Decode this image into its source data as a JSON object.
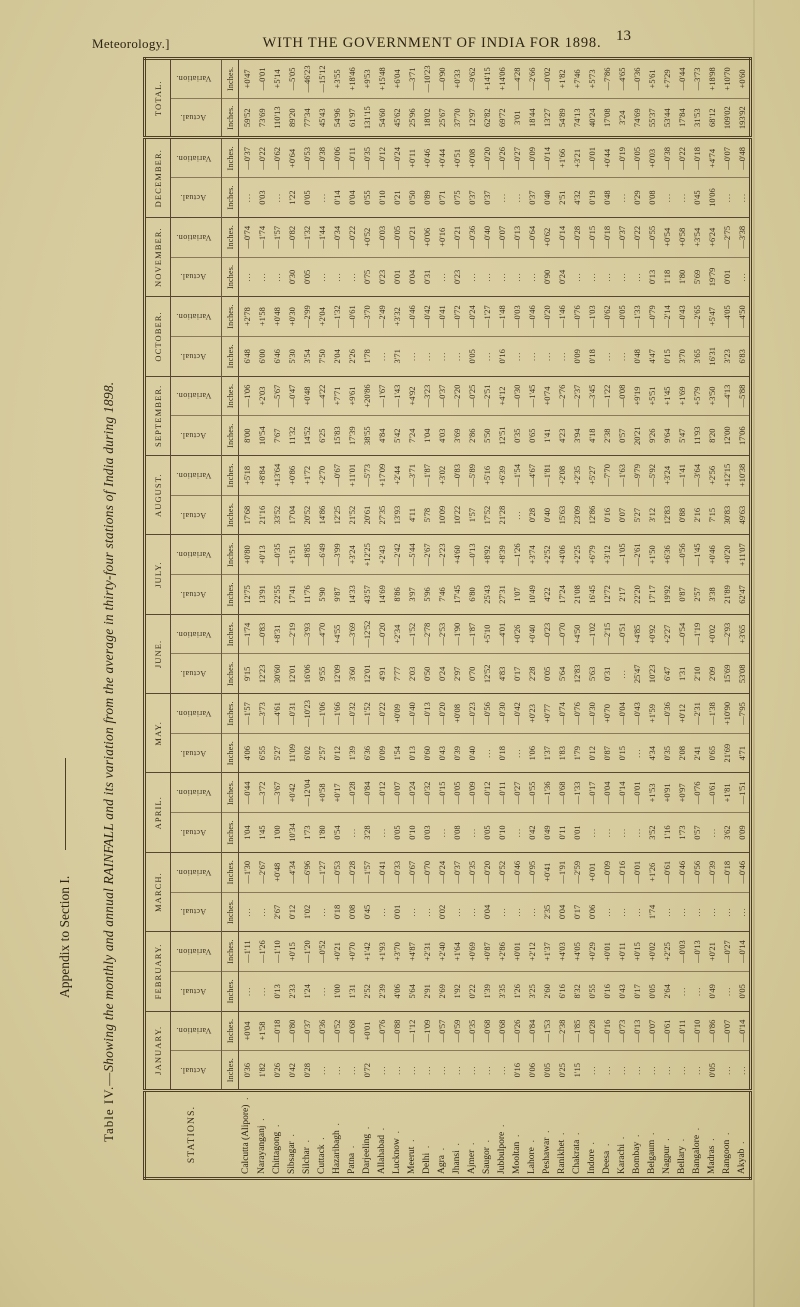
{
  "page": {
    "margin_note": "Meteorology.]",
    "header_title": "WITH THE GOVERNMENT OF INDIA FOR 1898.",
    "page_number": "13",
    "side_note": "Appendix to Section I.",
    "table_title_prefix": "Table IV.—",
    "table_title_rest": "Showing the monthly and annual RAINFALL and its variation from the average in thirty-four stations of India during 1898."
  },
  "table": {
    "stations_header": "Stations.",
    "unit_label": "Inches.",
    "sub_headers": [
      "Actual.",
      "Variation."
    ],
    "stations": [
      "Calcutta (Alipore)",
      "Narayanganj",
      "Chittagong",
      "Sibsagar",
      "Silchar",
      "Cuttack",
      "Hazaribagh",
      "Patna",
      "Darjeeling",
      "Allahabad",
      "Lucknow",
      "Meerut",
      "Delhi",
      "Agra",
      "Jhansi",
      "Ajmer",
      "Saugor",
      "Jubbulpore",
      "Mooltan",
      "Lahore",
      "Peshawar",
      "Ranikhet",
      "Chakrata",
      "Indore",
      "Deesa",
      "Karachi",
      "Bombay",
      "Belgaum",
      "Nagpur",
      "Bellary",
      "Bangalore",
      "Madras",
      "Rangoon",
      "Akyab"
    ],
    "months": [
      {
        "label": "January.",
        "actual": [
          "0'36",
          "1'82",
          "0'26",
          "0'42",
          "0'28",
          "...",
          "...",
          "...",
          "0'72",
          "...",
          "...",
          "...",
          "...",
          "...",
          "...",
          "...",
          "...",
          "...",
          "0'16",
          "0'06",
          "0'05",
          "0'25",
          "1'15",
          "...",
          "...",
          "...",
          "...",
          "...",
          "...",
          "...",
          "...",
          "0'05",
          "...",
          "..."
        ],
        "variation": [
          "+0'04",
          "+1'58",
          "—0'18",
          "—0'80",
          "—0'37",
          "—0'36",
          "—0'52",
          "—0'68",
          "+0'01",
          "—0'76",
          "—0'88",
          "—1'12",
          "—1'09",
          "—0'57",
          "—0'59",
          "—0'35",
          "—0'68",
          "—0'68",
          "—0'26",
          "—0'84",
          "—1'53",
          "—2'38",
          "—1'85",
          "—0'28",
          "—0'16",
          "—0'73",
          "—0'13",
          "—0'07",
          "—0'61",
          "—0'11",
          "—0'10",
          "—0'86",
          "—0'07",
          "—0'14"
        ]
      },
      {
        "label": "February.",
        "actual": [
          "...",
          "...",
          "0'13",
          "2'33",
          "1'24",
          "...",
          "1'00",
          "1'31",
          "2'52",
          "2'39",
          "4'06",
          "5'64",
          "2'91",
          "2'69",
          "1'92",
          "0'22",
          "1'39",
          "3'35",
          "1'26",
          "3'25",
          "2'60",
          "6'16",
          "8'32",
          "0'55",
          "0'16",
          "0'43",
          "0'17",
          "0'05",
          "2'64",
          "...",
          "...",
          "0'49",
          "...",
          "0'05"
        ],
        "variation": [
          "—1'11",
          "—1'26",
          "—1'10",
          "+0'15",
          "—1'20",
          "—0'52",
          "+0'21",
          "+0'70",
          "+1'42",
          "+1'93",
          "+3'70",
          "+4'87",
          "+2'31",
          "+2'40",
          "+1'64",
          "+0'69",
          "+0'87",
          "+2'86",
          "+0'01",
          "+2'12",
          "+1'37",
          "+4'03",
          "+4'05",
          "+0'29",
          "+0'01",
          "+0'11",
          "+0'15",
          "+0'02",
          "+2'25",
          "—0'03",
          "—0'13",
          "+0'21",
          "—0'27",
          "—0'14"
        ]
      },
      {
        "label": "March.",
        "actual": [
          "...",
          "...",
          "2'67",
          "0'12",
          "1'02",
          "...",
          "0'18",
          "0'08",
          "0'45",
          "...",
          "0'01",
          "...",
          "...",
          "0'02",
          "...",
          "...",
          "0'04",
          "...",
          "...",
          "...",
          "2'35",
          "0'04",
          "0'17",
          "0'06",
          "...",
          "...",
          "...",
          "1'74",
          "...",
          "...",
          "...",
          "...",
          "...",
          "..."
        ],
        "variation": [
          "—1'30",
          "—2'67",
          "+0'48",
          "—4'34",
          "—6'96",
          "—1'27",
          "—0'53",
          "—0'28",
          "—1'57",
          "—0'41",
          "—0'33",
          "—0'67",
          "—0'70",
          "—0'24",
          "—0'37",
          "—0'35",
          "—0'20",
          "—0'52",
          "—0'46",
          "—0'95",
          "+0'41",
          "—1'91",
          "—2'59",
          "+0'01",
          "—0'09",
          "—0'16",
          "—0'01",
          "+1'26",
          "—0'61",
          "—0'46",
          "—0'56",
          "—0'39",
          "—0'18",
          "—0'46"
        ]
      },
      {
        "label": "April.",
        "actual": [
          "1'04",
          "1'45",
          "1'00",
          "10'34",
          "1'73",
          "1'80",
          "0'54",
          "...",
          "3'28",
          "...",
          "0'05",
          "0'10",
          "0'03",
          "...",
          "0'08",
          "...",
          "0'05",
          "0'10",
          "...",
          "0'42",
          "0'49",
          "0'11",
          "0'01",
          "...",
          "...",
          "...",
          "...",
          "3'52",
          "1'16",
          "1'73",
          "0'57",
          "...",
          "3'62",
          "0'09"
        ],
        "variation": [
          "—0'44",
          "—3'72",
          "—3'67",
          "+0'42",
          "—12'04",
          "+0'58",
          "+0'17",
          "—0'28",
          "—0'84",
          "—0'12",
          "—0'07",
          "—0'24",
          "—0'32",
          "—0'15",
          "—0'05",
          "—0'09",
          "—0'12",
          "—0'11",
          "—0'27",
          "—0'55",
          "—1'36",
          "—0'68",
          "—1'33",
          "—0'17",
          "—0'04",
          "—0'14",
          "—0'01",
          "+1'53",
          "+0'91",
          "+0'97",
          "—0'76",
          "—0'61",
          "+1'81",
          "—1'51"
        ]
      },
      {
        "label": "May.",
        "actual": [
          "4'06",
          "6'55",
          "5'27",
          "11'09",
          "6'02",
          "2'57",
          "0'12",
          "1'39",
          "6'36",
          "0'09",
          "1'54",
          "0'13",
          "0'60",
          "0'43",
          "0'39",
          "0'40",
          "...",
          "0'18",
          "...",
          "1'06",
          "1'37",
          "1'83",
          "1'79",
          "0'12",
          "0'87",
          "0'15",
          "...",
          "4'34",
          "0'35",
          "2'08",
          "2'41",
          "0'65",
          "21'69",
          "4'71"
        ],
        "variation": [
          "—1'57",
          "—3'73",
          "—4'61",
          "—0'31",
          "—10'23",
          "—1'06",
          "—1'66",
          "—0'32",
          "—1'52",
          "—0'22",
          "+0'09",
          "—0'40",
          "—0'13",
          "—0'20",
          "+0'08",
          "—0'23",
          "—0'56",
          "—0'30",
          "—0'42",
          "+0'23",
          "+0'77",
          "—0'74",
          "—0'76",
          "—0'30",
          "+0'70",
          "—0'04",
          "—0'43",
          "+1'59",
          "—0'36",
          "+0'12",
          "—2'31",
          "—1'38",
          "+10'90",
          "—7'95"
        ]
      },
      {
        "label": "June.",
        "actual": [
          "9'15",
          "12'23",
          "30'60",
          "12'01",
          "16'06",
          "9'55",
          "12'09",
          "3'60",
          "12'01",
          "4'91",
          "7'77",
          "2'03",
          "0'50",
          "0'24",
          "2'97",
          "0'70",
          "12'52",
          "4'83",
          "0'17",
          "2'28",
          "0'05",
          "5'64",
          "12'83",
          "5'63",
          "0'31",
          "...",
          "25'47",
          "10'23",
          "6'47",
          "1'31",
          "2'10",
          "2'09",
          "15'69",
          "53'08"
        ],
        "variation": [
          "—1'74",
          "—0'83",
          "+8'31",
          "—2'19",
          "—3'93",
          "—4'70",
          "+4'55",
          "—3'69",
          "—12'52",
          "—0'20",
          "+2'34",
          "—1'52",
          "—2'78",
          "—2'53",
          "—1'90",
          "—1'87",
          "+5'10",
          "—4'01",
          "+0'26",
          "+0'40",
          "—0'23",
          "—0'70",
          "+4'50",
          "—1'02",
          "—2'15",
          "—0'51",
          "+4'85",
          "+0'92",
          "+2'27",
          "—0'54",
          "—1'19",
          "+0'02",
          "—2'93",
          "+3'65"
        ]
      },
      {
        "label": "July.",
        "actual": [
          "12'75",
          "13'91",
          "22'55",
          "17'41",
          "11'76",
          "5'90",
          "9'87",
          "14'33",
          "43'57",
          "14'69",
          "8'86",
          "3'97",
          "5'96",
          "7'46",
          "17'45",
          "6'80",
          "25'43",
          "27'31",
          "1'07",
          "10'49",
          "4'22",
          "17'24",
          "21'08",
          "16'45",
          "12'72",
          "2'17",
          "22'20",
          "17'17",
          "19'92",
          "0'87",
          "2'57",
          "3'38",
          "21'89",
          "62'47"
        ],
        "variation": [
          "+0'80",
          "+0'13",
          "—0'35",
          "+1'51",
          "—8'85",
          "—6'49",
          "—3'99",
          "+3'24",
          "+12'25",
          "+2'43",
          "—2'42",
          "—5'44",
          "—2'67",
          "—2'23",
          "+4'60",
          "—0'13",
          "+8'92",
          "+8'39",
          "—1'26",
          "+3'74",
          "+2'52",
          "+4'06",
          "+2'25",
          "+6'79",
          "+3'12",
          "—1'05",
          "—2'61",
          "+1'50",
          "+6'36",
          "—0'56",
          "—1'45",
          "+0'46",
          "+0'20",
          "+11'07"
        ]
      },
      {
        "label": "August.",
        "actual": [
          "17'68",
          "21'16",
          "33'52",
          "17'04",
          "20'52",
          "14'86",
          "12'25",
          "21'52",
          "20'61",
          "27'35",
          "13'93",
          "4'11",
          "5'78",
          "10'09",
          "10'22",
          "1'57",
          "17'52",
          "21'28",
          "...",
          "0'28",
          "0'40",
          "15'63",
          "23'09",
          "12'86",
          "0'16",
          "0'07",
          "5'27",
          "3'12",
          "12'83",
          "0'88",
          "2'16",
          "7'15",
          "30'83",
          "49'63"
        ],
        "variation": [
          "+5'18",
          "+8'84",
          "+13'64",
          "+0'86",
          "+1'72",
          "+2'70",
          "—0'67",
          "+11'01",
          "—5'73",
          "+17'09",
          "+2'44",
          "—3'71",
          "—1'87",
          "+3'02",
          "—0'83",
          "—5'89",
          "+5'16",
          "+6'39",
          "—1'54",
          "—4'67",
          "—1'81",
          "+2'08",
          "+2'35",
          "+5'27",
          "—7'70",
          "—1'63",
          "—9'79",
          "—5'92",
          "+3'24",
          "—1'41",
          "—3'64",
          "+2'56",
          "+12'15",
          "+10'38"
        ]
      },
      {
        "label": "September.",
        "actual": [
          "8'00",
          "10'54",
          "7'67",
          "11'32",
          "14'52",
          "6'25",
          "15'83",
          "17'39",
          "38'55",
          "4'84",
          "5'42",
          "7'24",
          "1'04",
          "4'03",
          "3'69",
          "2'86",
          "5'50",
          "12'51",
          "0'35",
          "0'65",
          "1'41",
          "4'23",
          "3'94",
          "4'18",
          "2'38",
          "0'57",
          "20'21",
          "9'26",
          "9'64",
          "5'47",
          "11'93",
          "8'20",
          "12'00",
          "17'06"
        ],
        "variation": [
          "—1'06",
          "+2'03",
          "—5'67",
          "—0'47",
          "+0'48",
          "—4'22",
          "+7'71",
          "+9'61",
          "+20'86",
          "—1'67",
          "—1'43",
          "+4'92",
          "—3'23",
          "—0'37",
          "—2'20",
          "—0'25",
          "—2'51",
          "+4'12",
          "—0'30",
          "—1'45",
          "+0'74",
          "—2'76",
          "—2'37",
          "—3'45",
          "—1'22",
          "—0'08",
          "+9'19",
          "+5'51",
          "+1'45",
          "+1'69",
          "+5'79",
          "+3'50",
          "—4'13",
          "—5'88"
        ]
      },
      {
        "label": "October.",
        "actual": [
          "6'48",
          "6'00",
          "6'46",
          "5'30",
          "3'54",
          "7'50",
          "2'04",
          "2'26",
          "1'78",
          "...",
          "3'71",
          "...",
          "...",
          "...",
          "...",
          "0'05",
          "...",
          "0'16",
          "...",
          "...",
          "...",
          "...",
          "0'09",
          "0'18",
          "...",
          "...",
          "0'48",
          "4'47",
          "0'15",
          "3'70",
          "3'65",
          "16'31",
          "3'23",
          "6'83"
        ],
        "variation": [
          "+2'78",
          "+1'58",
          "+0'48",
          "+0'30",
          "—2'99",
          "+2'04",
          "—1'32",
          "—0'61",
          "—3'70",
          "—2'49",
          "+3'32",
          "—0'46",
          "—0'42",
          "—0'41",
          "—0'72",
          "—0'24",
          "—1'27",
          "—1'48",
          "—0'03",
          "—0'46",
          "—0'20",
          "—1'46",
          "—0'76",
          "—1'03",
          "—0'62",
          "—0'05",
          "—1'33",
          "—0'79",
          "—2'14",
          "—0'43",
          "—2'65",
          "+5'47",
          "—4'05",
          "—4'50"
        ]
      },
      {
        "label": "November.",
        "actual": [
          "...",
          "...",
          "...",
          "0'30",
          "0'05",
          "...",
          "...",
          "...",
          "0'75",
          "0'23",
          "0'01",
          "0'04",
          "0'31",
          "...",
          "0'23",
          "...",
          "...",
          "...",
          "...",
          "...",
          "0'90",
          "0'24",
          "...",
          "...",
          "...",
          "...",
          "...",
          "0'13",
          "1'18",
          "1'80",
          "5'69",
          "19'79",
          "0'01",
          "..."
        ],
        "variation": [
          "—0'74",
          "—1'74",
          "—1'57",
          "—0'82",
          "—1'32",
          "—1'44",
          "—0'34",
          "—0'22",
          "+0'52",
          "—0'03",
          "—0'05",
          "—0'21",
          "+0'06",
          "+0'16",
          "—0'21",
          "—0'36",
          "—0'40",
          "—0'07",
          "—0'13",
          "—0'64",
          "+0'62",
          "—0'14",
          "—0'28",
          "—0'15",
          "—0'18",
          "—0'37",
          "—0'22",
          "—0'55",
          "+0'54",
          "+0'58",
          "+3'54",
          "+6'24",
          "—2'75",
          "—3'38"
        ]
      },
      {
        "label": "December.",
        "actual": [
          "...",
          "0'03",
          "...",
          "1'22",
          "0'05",
          "...",
          "0'14",
          "0'04",
          "0'55",
          "0'10",
          "0'21",
          "0'50",
          "0'89",
          "0'71",
          "0'75",
          "0'37",
          "0'37",
          "...",
          "...",
          "0'37",
          "0'40",
          "2'51",
          "4'32",
          "0'19",
          "0'48",
          "...",
          "0'29",
          "0'08",
          "...",
          "...",
          "0'45",
          "10'06",
          "...",
          "..."
        ],
        "variation": [
          "—0'37",
          "—0'22",
          "—0'62",
          "+0'64",
          "—0'53",
          "—0'38",
          "—0'06",
          "—0'11",
          "—0'35",
          "—0'12",
          "—0'24",
          "+0'11",
          "+0'46",
          "+0'44",
          "+0'51",
          "+0'08",
          "—0'20",
          "—0'26",
          "—0'27",
          "—0'09",
          "—0'14",
          "+1'66",
          "+3'21",
          "—0'01",
          "+0'44",
          "—0'19",
          "—0'05",
          "+0'03",
          "—0'38",
          "—0'22",
          "—0'18",
          "+4'74",
          "—0'07",
          "—0'48"
        ]
      },
      {
        "label": "Total.",
        "actual": [
          "59'52",
          "73'69",
          "110'13",
          "89'20",
          "77'34",
          "45'43",
          "54'96",
          "61'97",
          "131'15",
          "54'60",
          "45'62",
          "25'96",
          "18'02",
          "25'67",
          "37'70",
          "12'97",
          "62'82",
          "69'72",
          "3'01",
          "18'44",
          "13'27",
          "54'89",
          "74'13",
          "40'24",
          "17'08",
          "3'24",
          "74'69",
          "55'37",
          "53'44",
          "17'84",
          "31'53",
          "68'12",
          "109'02",
          "193'92"
        ],
        "variation": [
          "+0'47",
          "—0'01",
          "+5'14",
          "—5'05",
          "—46'23",
          "—15'12",
          "+3'55",
          "+18'46",
          "+9'53",
          "+15'48",
          "+6'04",
          "—3'71",
          "—10'23",
          "—0'90",
          "+0'33",
          "—9'62",
          "+14'15",
          "+14'06",
          "—4'28",
          "—2'66",
          "—0'02",
          "+1'82",
          "+7'46",
          "+5'73",
          "—7'86",
          "—4'65",
          "—0'36",
          "+5'61",
          "+7'29",
          "—0'44",
          "—3'73",
          "+18'98",
          "+10'70",
          "+0'60"
        ]
      }
    ]
  }
}
